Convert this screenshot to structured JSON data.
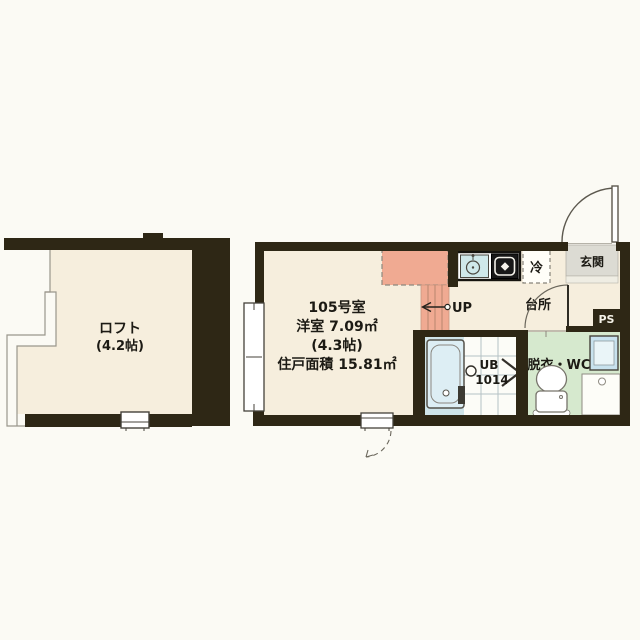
{
  "plan": {
    "loft": {
      "name": "ロフト",
      "size": "(4.2帖)"
    },
    "main_room": {
      "room_number": "105号室",
      "room_type_area": "洋室 7.09㎡",
      "size": "(4.3帖)",
      "total_area": "住戸面積 15.81㎡"
    },
    "entrance": {
      "label": "玄関"
    },
    "kitchen": {
      "label": "台所"
    },
    "refrigerator": {
      "label": "冷"
    },
    "bathroom": {
      "label_line1": "UB",
      "label_line2": "1014"
    },
    "washroom": {
      "label": "脱衣・WC"
    },
    "pipe_space": {
      "label": "PS"
    },
    "stairs": {
      "label": "UP"
    }
  },
  "colors": {
    "wall": "#2e2715",
    "room_floor": "#f6eedd",
    "loft_overhang": "#f0aa92",
    "stairs": "#f0aa92",
    "bath_floor": "#cfe4e9",
    "bathtub": "#ddeef4",
    "washroom_floor": "#d6e9ce",
    "entrance_floor": "#dcdbd3",
    "entrance_step": "#efede3",
    "sink": "#cfe8ea",
    "washbasin": "#c8e2ee",
    "stove": "#181818",
    "page_background": "#fbfaf4"
  }
}
